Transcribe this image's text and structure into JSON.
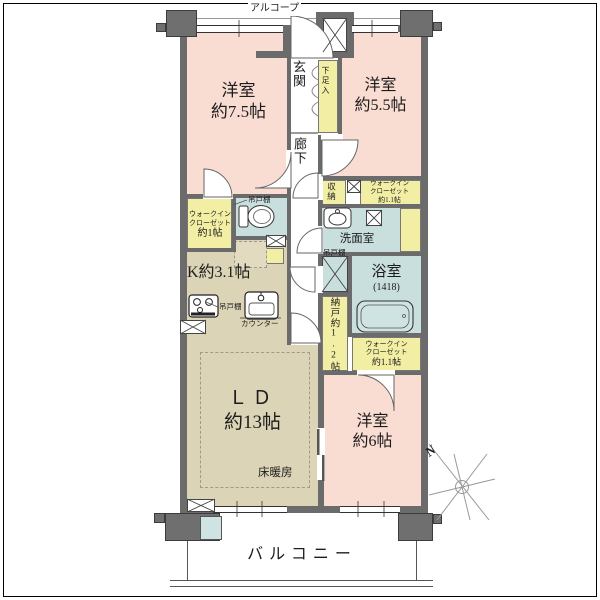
{
  "meta": {
    "type": "Japanese apartment floor plan"
  },
  "colors": {
    "wall": "#6b6b6b",
    "room_pink": "#f9dcd2",
    "living_tan": "#dcd4b6",
    "closet_yellow": "#f2efa5",
    "wet_area_blue": "#c9dfde",
    "background": "#ffffff"
  },
  "areas": {
    "alcove": {
      "label": "アルコープ"
    },
    "entrance": {
      "label": "玄関"
    },
    "shoe_closet": {
      "label": "下足入"
    },
    "corridor": {
      "label": "廊下"
    },
    "room_75": {
      "label": "洋室",
      "size": "約7.5帖"
    },
    "room_55": {
      "label": "洋室",
      "size": "約5.5帖"
    },
    "room_6": {
      "label": "洋室",
      "size": "約6帖"
    },
    "living_dining": {
      "label": "ＬＤ",
      "size": "約13帖",
      "floor_heating": "床暖房"
    },
    "kitchen": {
      "label": "K約3.1帖"
    },
    "storage": {
      "label": "収納"
    },
    "wic_left": {
      "line1": "ウォークイン",
      "line2": "クローゼット",
      "line3": "約1帖"
    },
    "wic_top": {
      "line1": "ウォークイン",
      "line2": "クローゼット",
      "line3": "約1.1帖"
    },
    "wic_bottom": {
      "line1": "ウォークイン",
      "line2": "クローゼット",
      "line3": "約1.1帖"
    },
    "washroom": {
      "label": "洗面室"
    },
    "bathroom": {
      "label": "浴室",
      "size": "(1418)"
    },
    "pantry": {
      "label": "納戸約1.2帖"
    },
    "balcony": {
      "label": "バルコニー"
    }
  },
  "fixtures": {
    "cupboard_toilet": "吊戸棚",
    "cupboard_bath": "吊戸棚",
    "cupboard_kitchen": "吊戸棚",
    "counter": "カウンター"
  },
  "compass": {
    "north": "N"
  }
}
